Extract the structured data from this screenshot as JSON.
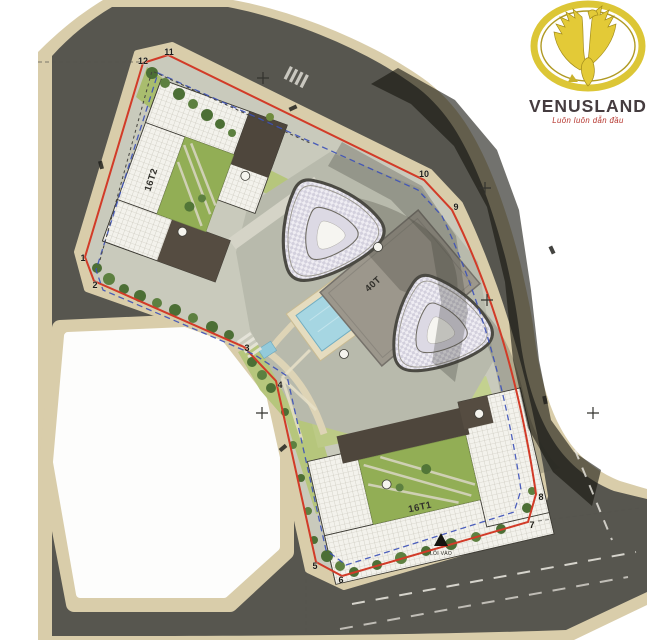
{
  "title": "Venusland residential complex master plan",
  "logo": {
    "brand": "VENUSLAND",
    "tagline": "Luôn luôn dẫn đầu",
    "colors": {
      "gold": "#dcc636",
      "gold_dark": "#a28c1c",
      "brand_text": "#453c3f",
      "tagline_text": "#b5342c"
    }
  },
  "plan": {
    "building_labels": {
      "b16t2": "16T2",
      "b16t1": "16T1",
      "tower_block": "40T"
    },
    "entrance_label": "LỐI VÀO",
    "boundary_points": [
      {
        "label": "1"
      },
      {
        "label": "2"
      },
      {
        "label": "3"
      },
      {
        "label": "4"
      },
      {
        "label": "5"
      },
      {
        "label": "6"
      },
      {
        "label": "7"
      },
      {
        "label": "8"
      },
      {
        "label": "9"
      },
      {
        "label": "10"
      },
      {
        "label": "11"
      },
      {
        "label": "12"
      }
    ]
  },
  "colors": {
    "road": "#57564f",
    "sidewalk": "#d9cdaa",
    "site_paving": "#c9cabc",
    "plaza": "#b8baac",
    "lawn": "#b6c67c",
    "courtyard_green": "#92ae55",
    "boundary_red": "#d23b28",
    "setback_blue": "#3b50b8",
    "pool_blue": "#a6d6e2",
    "roof_dark": "#4e463c",
    "shadow": "#14140e"
  }
}
